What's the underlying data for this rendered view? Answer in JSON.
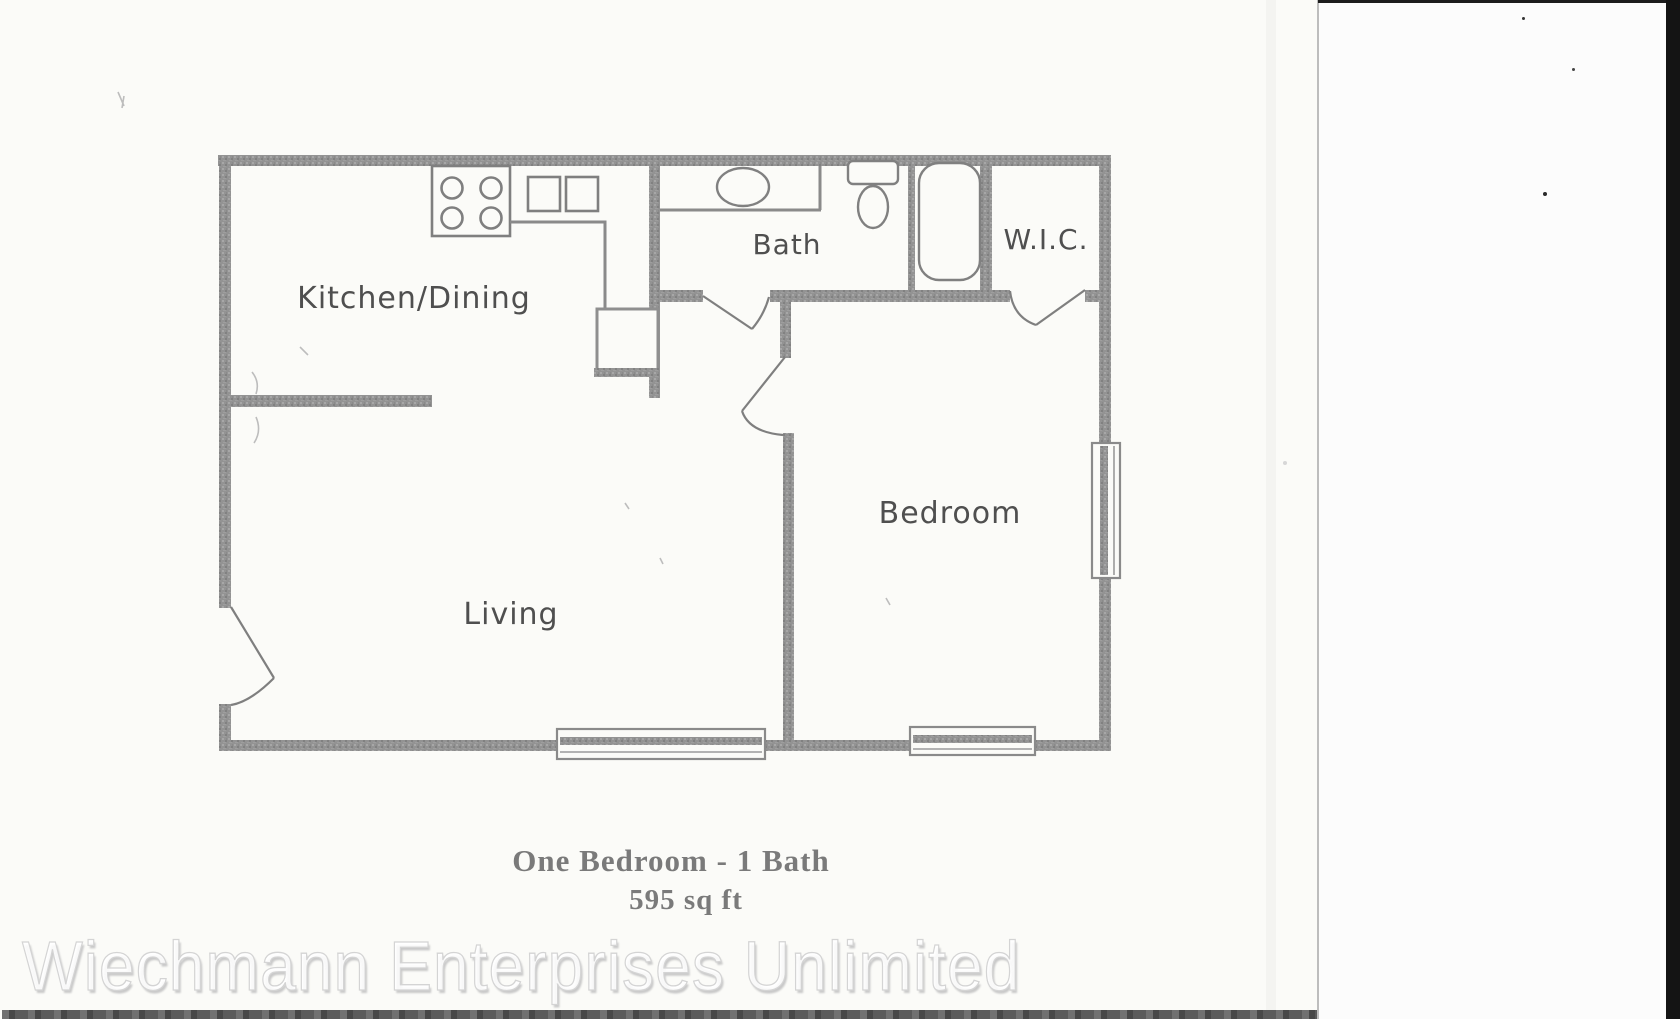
{
  "document": {
    "kind": "scanned apartment floor plan",
    "caption": {
      "title": "One Bedroom - 1 Bath",
      "area": "595 sq ft"
    },
    "watermark": "Wiechmann Enterprises Unlimited"
  },
  "floor_plan": {
    "rooms": [
      {
        "name": "Kitchen/Dining"
      },
      {
        "name": "Bath"
      },
      {
        "name": "W.I.C."
      },
      {
        "name": "Bedroom"
      },
      {
        "name": "Living"
      }
    ],
    "fixture_icons": [
      "stove-4-burner-icon",
      "double-sink-icon",
      "vanity-sink-icon",
      "toilet-icon",
      "bathtub-icon",
      "closet-box-icon"
    ],
    "features": {
      "windows": 3,
      "doors": 4
    }
  },
  "colors": {
    "paper": "#fbfbf8",
    "wall_gray": "#8f8f8f",
    "fixture_line": "#808080",
    "room_label": "#4f4f4f",
    "caption_text": "#7a7a7a",
    "bottom_bar": "#525252",
    "scanner_edge": "#141414",
    "watermark_shadow": "#c9c9c9"
  }
}
